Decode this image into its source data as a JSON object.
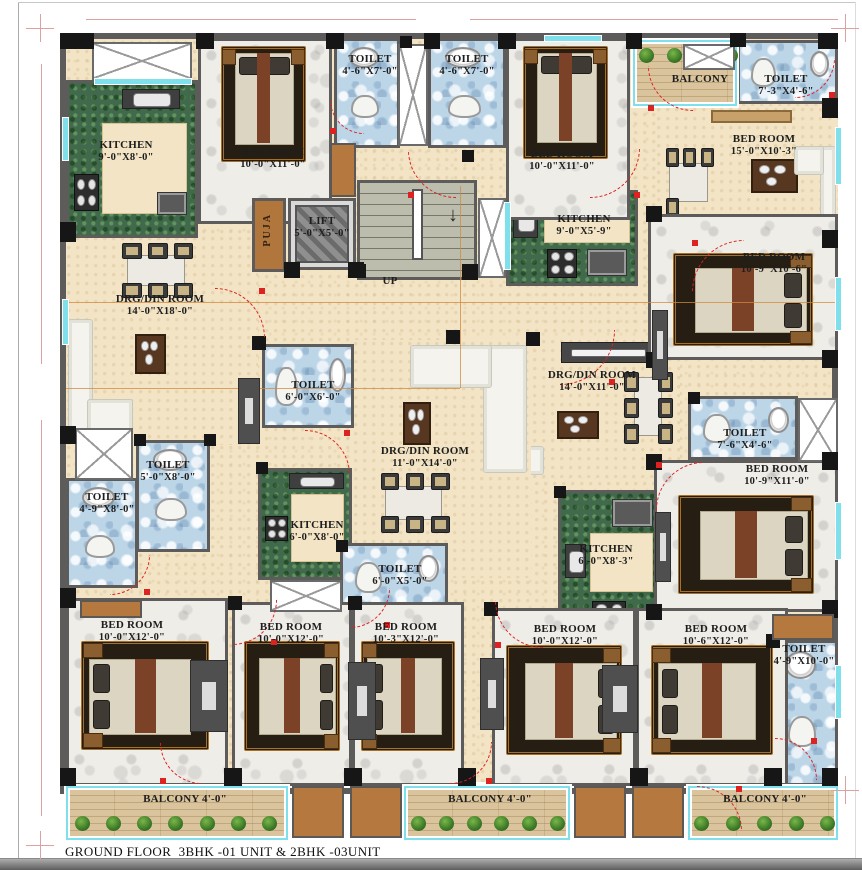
{
  "title": "GROUND FLOOR  3BHK -01 UNIT & 2BHK -03UNIT",
  "stairs": {
    "up_label": "UP",
    "down_arrow": "↓"
  },
  "colors": {
    "wall": "#5e5c5a",
    "beige": "#f2e4c4",
    "marble_white": "#efede8",
    "toilet_blue": "#bcd6e8",
    "kitchen_green": "#41694b",
    "wood": "#d9c49d",
    "stair_gray": "#bdbdae",
    "puja_brown": "#b0763c",
    "accent_red": "#dd2222",
    "window_cyan": "#7fe0ec",
    "column_black": "#161616"
  },
  "rooms": [
    {
      "id": "drg-din-a",
      "name": "DRG/DIN ROOM",
      "dims": "14'-0\"X18'-0\"",
      "type": "drgdin",
      "x": 66,
      "y": 235,
      "w": 192,
      "h": 210,
      "lx": 160,
      "ly": 300,
      "furniture": [
        {
          "kind": "dining",
          "seats": 6,
          "x": 26,
          "y": 4,
          "w": 42,
          "h": 26
        },
        {
          "kind": "sofa",
          "corner": "left",
          "x": 1,
          "y": 40,
          "w": 34,
          "h": 58
        },
        {
          "kind": "coffee",
          "x": 36,
          "y": 47,
          "w": 16,
          "h": 19
        }
      ]
    },
    {
      "id": "drg-din-b",
      "name": "DRG/DIN ROOM",
      "dims": "14'-0\"X11'-0\"",
      "type": "drgdin",
      "x": 460,
      "y": 338,
      "w": 220,
      "h": 140,
      "lx": 592,
      "ly": 376,
      "furniture": [
        {
          "kind": "tv",
          "x": 46,
          "y": 3,
          "w": 42,
          "h": 15
        },
        {
          "kind": "sofa",
          "corner": "left",
          "x": 8,
          "y": 36,
          "w": 30,
          "h": 62
        },
        {
          "kind": "coffee",
          "x": 44,
          "y": 52,
          "w": 19,
          "h": 20
        },
        {
          "kind": "dining",
          "seats": 6,
          "vert": true,
          "x": 74,
          "y": 20,
          "w": 23,
          "h": 58
        }
      ]
    },
    {
      "id": "drg-din-c",
      "name": "DRG/DIN ROOM",
      "dims": "11'-0\"X14'-0\"",
      "type": "drgdin",
      "x": 353,
      "y": 340,
      "w": 178,
      "h": 238,
      "lx": 425,
      "ly": 452,
      "furniture": [
        {
          "kind": "sofa",
          "corner": "right",
          "x": 32,
          "y": 2,
          "w": 66,
          "h": 54
        },
        {
          "kind": "coffee",
          "x": 28,
          "y": 26,
          "w": 16,
          "h": 18
        },
        {
          "kind": "dining",
          "seats": 6,
          "x": 12,
          "y": 56,
          "w": 44,
          "h": 25
        }
      ]
    },
    {
      "id": "bedroom-c",
      "name": "BED ROOM",
      "dims": "15'-0\"X10'-3\"",
      "type": "living",
      "x": 656,
      "y": 106,
      "w": 182,
      "h": 132,
      "lx": 764,
      "ly": 140,
      "furniture": [
        {
          "kind": "wardrobe",
          "x": 30,
          "y": 3,
          "w": 45,
          "h": 10
        },
        {
          "kind": "dining",
          "seats": 4,
          "x": 3,
          "y": 32,
          "w": 30,
          "h": 52
        },
        {
          "kind": "coffee",
          "x": 52,
          "y": 40,
          "w": 26,
          "h": 26
        },
        {
          "kind": "sofa",
          "corner": "right",
          "x": 76,
          "y": 30,
          "w": 23,
          "h": 66
        }
      ]
    },
    {
      "id": "kitchen-a",
      "name": "KITCHEN",
      "dims": "9'-0\"X8'-0\"",
      "type": "kitchen",
      "x": 66,
      "y": 80,
      "w": 132,
      "h": 158,
      "lx": 126,
      "ly": 146,
      "furniture": [
        {
          "kind": "sink",
          "x": 42,
          "y": 4,
          "w": 46,
          "h": 13
        },
        {
          "kind": "inner",
          "x": 26,
          "y": 26,
          "w": 68,
          "h": 60
        },
        {
          "kind": "stove",
          "x": 4,
          "y": 60,
          "w": 20,
          "h": 24
        },
        {
          "kind": "counter",
          "x": 70,
          "y": 72,
          "w": 24,
          "h": 15
        }
      ]
    },
    {
      "id": "kitchen-b",
      "name": "KITCHEN",
      "dims": "9'-0\"X5'-9\"",
      "type": "kitchen",
      "x": 506,
      "y": 190,
      "w": 132,
      "h": 96,
      "lx": 584,
      "ly": 220,
      "furniture": [
        {
          "kind": "sink",
          "x": 3,
          "y": 6,
          "w": 20,
          "h": 44
        },
        {
          "kind": "inner",
          "x": 28,
          "y": 4,
          "w": 68,
          "h": 52
        },
        {
          "kind": "stove",
          "x": 30,
          "y": 62,
          "w": 24,
          "h": 32
        },
        {
          "kind": "counter",
          "x": 62,
          "y": 62,
          "w": 32,
          "h": 30
        }
      ]
    },
    {
      "id": "kitchen-c",
      "name": "KITCHEN",
      "dims": "6'-0\"X8'-0\"",
      "type": "kitchen",
      "x": 258,
      "y": 468,
      "w": 94,
      "h": 112,
      "lx": 317,
      "ly": 526,
      "furniture": [
        {
          "kind": "sink",
          "x": 32,
          "y": 2,
          "w": 62,
          "h": 15
        },
        {
          "kind": "stove",
          "x": 5,
          "y": 42,
          "w": 26,
          "h": 24
        },
        {
          "kind": "inner",
          "x": 34,
          "y": 22,
          "w": 60,
          "h": 64
        }
      ]
    },
    {
      "id": "kitchen-d",
      "name": "KITCHEN",
      "dims": "6'-0\"X8'-3\"",
      "type": "kitchen",
      "x": 558,
      "y": 490,
      "w": 104,
      "h": 148,
      "lx": 606,
      "ly": 550,
      "furniture": [
        {
          "kind": "counter",
          "x": 52,
          "y": 4,
          "w": 42,
          "h": 20
        },
        {
          "kind": "sink",
          "x": 4,
          "y": 36,
          "w": 22,
          "h": 24
        },
        {
          "kind": "inner",
          "x": 30,
          "y": 28,
          "w": 64,
          "h": 42
        },
        {
          "kind": "stove",
          "x": 32,
          "y": 76,
          "w": 34,
          "h": 17
        }
      ]
    },
    {
      "id": "toilet-a1",
      "name": "TOILET",
      "dims": "4'-6\"X7'-0\"",
      "type": "toilet",
      "x": 334,
      "y": 38,
      "w": 66,
      "h": 110,
      "lx": 370,
      "ly": 60
    },
    {
      "id": "toilet-a2",
      "name": "TOILET",
      "dims": "4'-6\"X7'-0\"",
      "type": "toilet",
      "x": 428,
      "y": 38,
      "w": 78,
      "h": 110,
      "lx": 467,
      "ly": 60
    },
    {
      "id": "toilet-b1",
      "name": "TOILET",
      "dims": "7'-3\"X4'-6\"",
      "type": "toilet",
      "x": 737,
      "y": 40,
      "w": 101,
      "h": 64,
      "lx": 786,
      "ly": 80
    },
    {
      "id": "toilet-c",
      "name": "TOILET",
      "dims": "6'-0\"X6'-0\"",
      "type": "toilet",
      "x": 262,
      "y": 344,
      "w": 92,
      "h": 84,
      "lx": 313,
      "ly": 386
    },
    {
      "id": "toilet-d",
      "name": "TOILET",
      "dims": "7'-6\"X4'-6\"",
      "type": "toilet",
      "x": 688,
      "y": 396,
      "w": 110,
      "h": 64,
      "lx": 745,
      "ly": 434
    },
    {
      "id": "toilet-e",
      "name": "TOILET",
      "dims": "5'-0\"X8'-0\"",
      "type": "toilet",
      "x": 136,
      "y": 440,
      "w": 74,
      "h": 112,
      "lx": 168,
      "ly": 466
    },
    {
      "id": "toilet-f",
      "name": "TOILET",
      "dims": "4'-9\"X8'-0\"",
      "type": "toilet",
      "x": 66,
      "y": 478,
      "w": 72,
      "h": 110,
      "lx": 107,
      "ly": 498
    },
    {
      "id": "toilet-g",
      "name": "TOILET",
      "dims": "6'-0\"X5'-0\"",
      "type": "toilet",
      "x": 340,
      "y": 543,
      "w": 108,
      "h": 68,
      "lx": 400,
      "ly": 570
    },
    {
      "id": "toilet-h",
      "name": "TOILET",
      "dims": "4'-9\"X10'-0\"",
      "type": "toilet",
      "x": 770,
      "y": 640,
      "w": 68,
      "h": 146,
      "lx": 804,
      "ly": 650
    },
    {
      "id": "bedroom-a",
      "name": "BED ROOM",
      "dims": "10'-0\"X11'-0\"",
      "type": "bedroom",
      "x": 198,
      "y": 38,
      "w": 134,
      "h": 186,
      "lx": 273,
      "ly": 153,
      "furniture": [
        {
          "kind": "bed",
          "dir": "N",
          "x": 16,
          "y": 3,
          "w": 66,
          "h": 64
        }
      ]
    },
    {
      "id": "bedroom-b",
      "name": "BED ROOM",
      "dims": "10'-0\"X11'-0\"",
      "type": "bedroom",
      "x": 506,
      "y": 38,
      "w": 124,
      "h": 182,
      "lx": 562,
      "ly": 155,
      "furniture": [
        {
          "kind": "bed",
          "dir": "N",
          "x": 12,
          "y": 3,
          "w": 72,
          "h": 64
        }
      ]
    },
    {
      "id": "bedroom-d",
      "name": "BED ROOM",
      "dims": "10'-9\"X10'-6\"",
      "type": "bedroom",
      "x": 648,
      "y": 214,
      "w": 190,
      "h": 146,
      "lx": 774,
      "ly": 258,
      "furniture": [
        {
          "kind": "bed",
          "dir": "E",
          "x": 12,
          "y": 26,
          "w": 76,
          "h": 66
        }
      ]
    },
    {
      "id": "bedroom-e",
      "name": "BED ROOM",
      "dims": "10'-9\"X11'-0\"",
      "type": "bedroom",
      "x": 654,
      "y": 460,
      "w": 184,
      "h": 152,
      "lx": 777,
      "ly": 470,
      "furniture": [
        {
          "kind": "bed",
          "dir": "E",
          "x": 12,
          "y": 22,
          "w": 76,
          "h": 68
        }
      ]
    },
    {
      "id": "bedroom-f",
      "name": "BED ROOM",
      "dims": "10'-0\"X12'-0\"",
      "type": "bedroom",
      "x": 66,
      "y": 598,
      "w": 162,
      "h": 188,
      "lx": 132,
      "ly": 626,
      "furniture": [
        {
          "kind": "bed",
          "dir": "W",
          "x": 8,
          "y": 22,
          "w": 82,
          "h": 60
        }
      ]
    },
    {
      "id": "bedroom-g",
      "name": "BED ROOM",
      "dims": "10'-0\"X12'-0\"",
      "type": "bedroom",
      "x": 232,
      "y": 602,
      "w": 120,
      "h": 184,
      "lx": 291,
      "ly": 628,
      "furniture": [
        {
          "kind": "bed",
          "dir": "E",
          "x": 8,
          "y": 20,
          "w": 84,
          "h": 62
        }
      ]
    },
    {
      "id": "bedroom-h",
      "name": "BED ROOM",
      "dims": "10'-3\"X12'-0\"",
      "type": "bedroom",
      "x": 352,
      "y": 602,
      "w": 112,
      "h": 184,
      "lx": 406,
      "ly": 628,
      "furniture": [
        {
          "kind": "bed",
          "dir": "W",
          "x": 6,
          "y": 20,
          "w": 88,
          "h": 62
        }
      ]
    },
    {
      "id": "bedroom-i",
      "name": "BED ROOM",
      "dims": "10'-0\"X12'-0\"",
      "type": "bedroom",
      "x": 492,
      "y": 608,
      "w": 144,
      "h": 178,
      "lx": 565,
      "ly": 630,
      "furniture": [
        {
          "kind": "bed",
          "dir": "E",
          "x": 8,
          "y": 20,
          "w": 84,
          "h": 64
        }
      ]
    },
    {
      "id": "bedroom-j",
      "name": "BED ROOM",
      "dims": "10'-6\"X12'-0\"",
      "type": "bedroom",
      "x": 636,
      "y": 608,
      "w": 152,
      "h": 178,
      "lx": 716,
      "ly": 630,
      "furniture": [
        {
          "kind": "bed",
          "dir": "W",
          "x": 8,
          "y": 20,
          "w": 84,
          "h": 64
        }
      ]
    },
    {
      "id": "balcony-top",
      "name": "BALCONY",
      "type": "balcony",
      "x": 633,
      "y": 40,
      "w": 104,
      "h": 66,
      "lx": 700,
      "ly": 80,
      "furniture": [
        {
          "kind": "shrubs",
          "n": 4,
          "x": 4,
          "y": 10,
          "w": 92,
          "h": 26
        }
      ]
    },
    {
      "id": "balcony-left",
      "name": "BALCONY 4'-0\"",
      "type": "balcony",
      "x": 66,
      "y": 786,
      "w": 222,
      "h": 54,
      "lx": 185,
      "ly": 800
    },
    {
      "id": "balcony-mid",
      "name": "BALCONY 4'-0\"",
      "type": "balcony",
      "x": 404,
      "y": 786,
      "w": 166,
      "h": 54,
      "lx": 490,
      "ly": 800
    },
    {
      "id": "balcony-right",
      "name": "BALCONY 4'-0\"",
      "type": "balcony",
      "x": 688,
      "y": 786,
      "w": 150,
      "h": 54,
      "lx": 765,
      "ly": 800
    },
    {
      "id": "puja",
      "name": "PUJA",
      "type": "puja",
      "x": 252,
      "y": 198,
      "w": 34,
      "h": 74,
      "vert": true,
      "lx": 269,
      "ly": 235
    },
    {
      "id": "lift",
      "name": "LIFT",
      "dims": "5'-0\"X5'-0\"",
      "type": "lift",
      "x": 288,
      "y": 198,
      "w": 68,
      "h": 72,
      "lx": 322,
      "ly": 222
    },
    {
      "id": "stairs",
      "name": "UP",
      "type": "stairs",
      "x": 357,
      "y": 180,
      "w": 120,
      "h": 100,
      "lx": 390,
      "ly": 282
    }
  ]
}
